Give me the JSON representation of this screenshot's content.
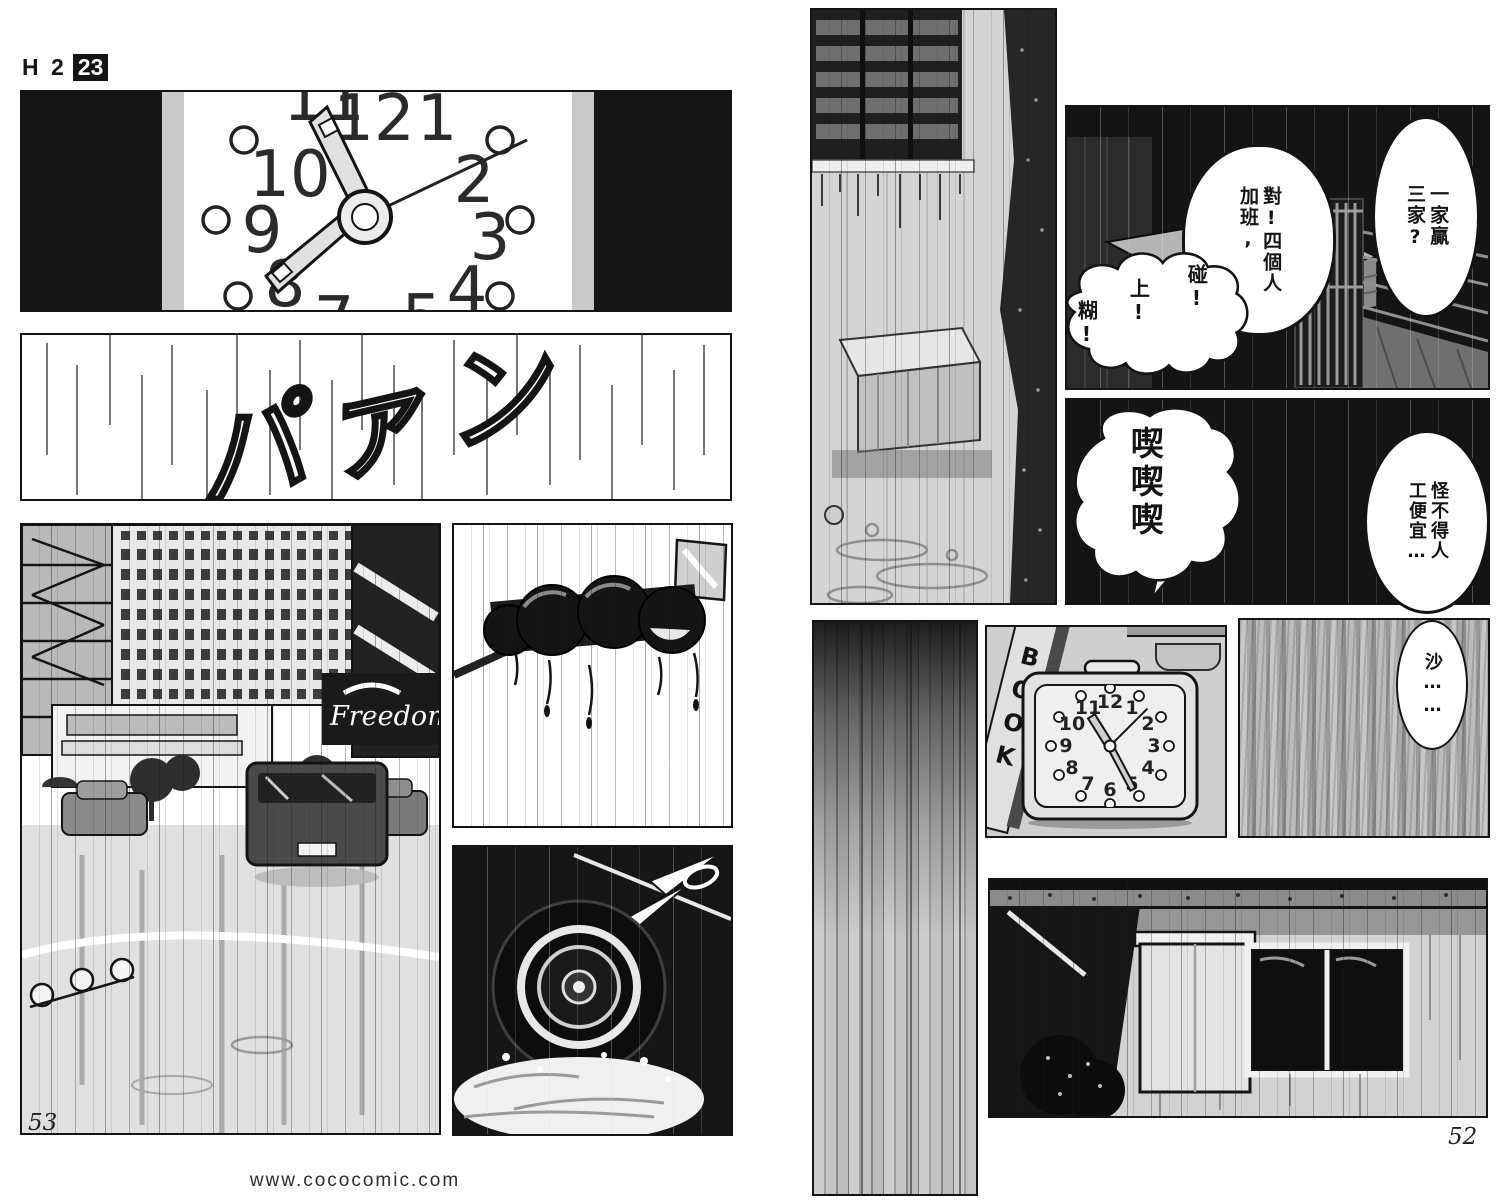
{
  "header": {
    "title": "H 2",
    "volume_badge": "23"
  },
  "footer": {
    "left_page_number": "53",
    "right_page_number": "52",
    "watermark": "www.cococomic.com"
  },
  "left_page": {
    "clock_numbers": [
      "11",
      "12",
      "1",
      "2",
      "3",
      "4",
      "5",
      "7",
      "8",
      "9",
      "10"
    ],
    "sfx_slam": "パァン",
    "freedom_sign": "Freedom"
  },
  "right_page": {
    "book_spine": "BOOK",
    "clock_numbers": [
      "12",
      "1",
      "2",
      "3",
      "4",
      "5",
      "6",
      "7",
      "8",
      "9",
      "10",
      "11"
    ],
    "bubbles": {
      "one_wins": [
        "一家贏",
        "三家?"
      ],
      "overtime": [
        "對!四個人",
        "加班,"
      ],
      "pong": "碰!",
      "up": "上!",
      "hu": "糊!",
      "giggle": "喫喫喫",
      "cheap_labor": [
        "怪不得人",
        "工便宜…"
      ],
      "rustle": "沙……"
    }
  },
  "colors": {
    "ink": "#141414",
    "paper": "#ffffff",
    "halftone": "#d4d4d4"
  }
}
